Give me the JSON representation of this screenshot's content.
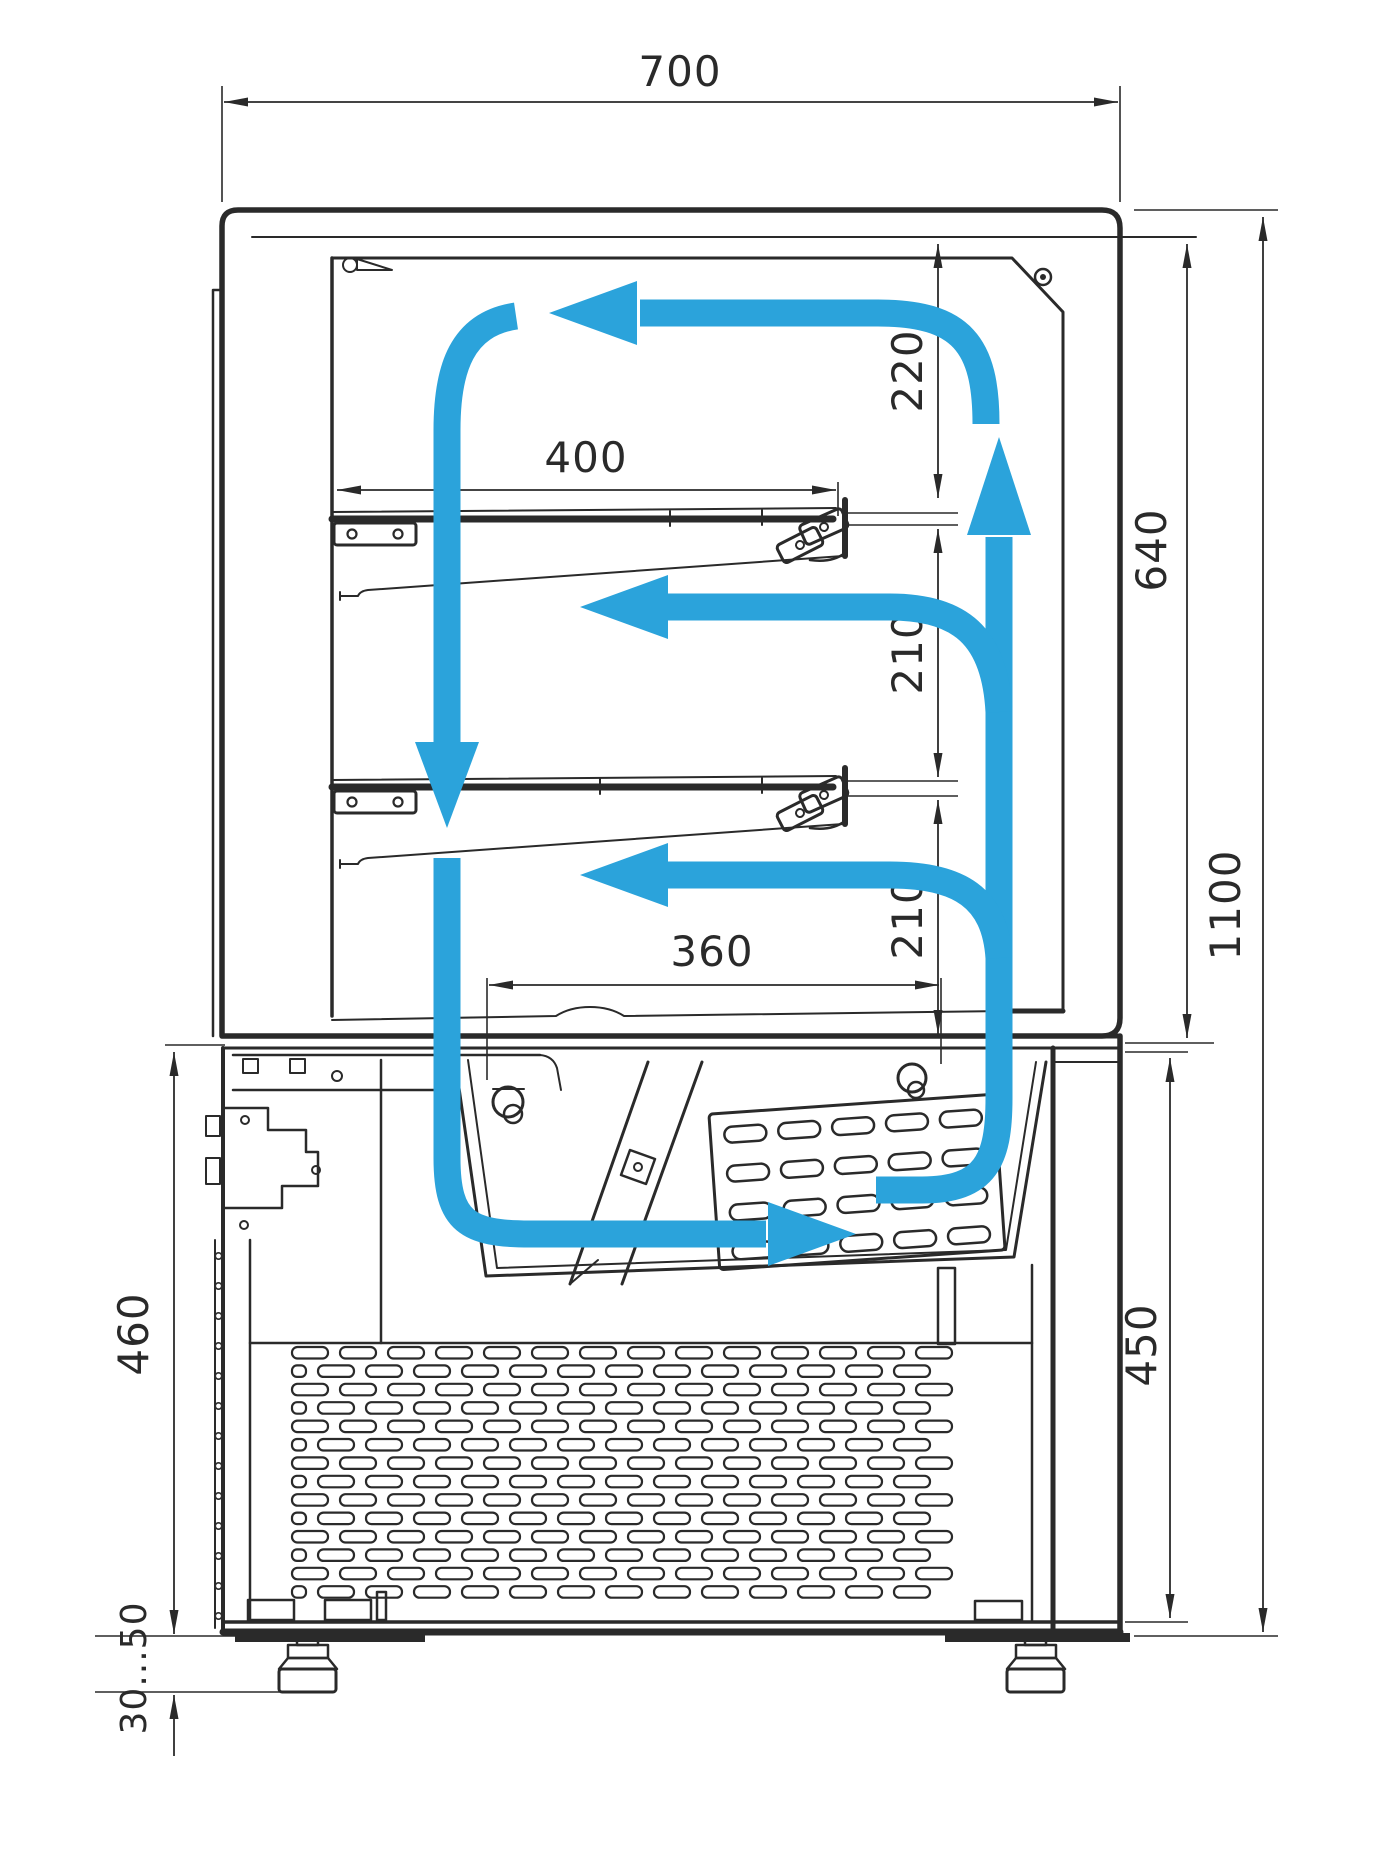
{
  "diagram": {
    "type": "technical-drawing",
    "subject": "refrigerated-display-case-cross-section-with-airflow",
    "colors": {
      "line": "#2a2a2a",
      "airflow": "#2ba3db",
      "background": "#ffffff"
    },
    "dimensions": {
      "overall_width": {
        "label": "700",
        "orientation": "horizontal"
      },
      "shelf_width": {
        "label": "400",
        "orientation": "horizontal"
      },
      "well_width": {
        "label": "360",
        "orientation": "horizontal"
      },
      "gap_top_shelf": {
        "label": "220",
        "orientation": "vertical"
      },
      "gap_shelf1": {
        "label": "210",
        "orientation": "vertical"
      },
      "gap_shelf2": {
        "label": "210",
        "orientation": "vertical"
      },
      "interior_height": {
        "label": "640",
        "orientation": "vertical"
      },
      "overall_height": {
        "label": "1100",
        "orientation": "vertical"
      },
      "base_height": {
        "label": "450",
        "orientation": "vertical"
      },
      "base_height_left": {
        "label": "460",
        "orientation": "vertical"
      },
      "foot_adjustment": {
        "label": "30...50",
        "orientation": "vertical"
      }
    }
  }
}
